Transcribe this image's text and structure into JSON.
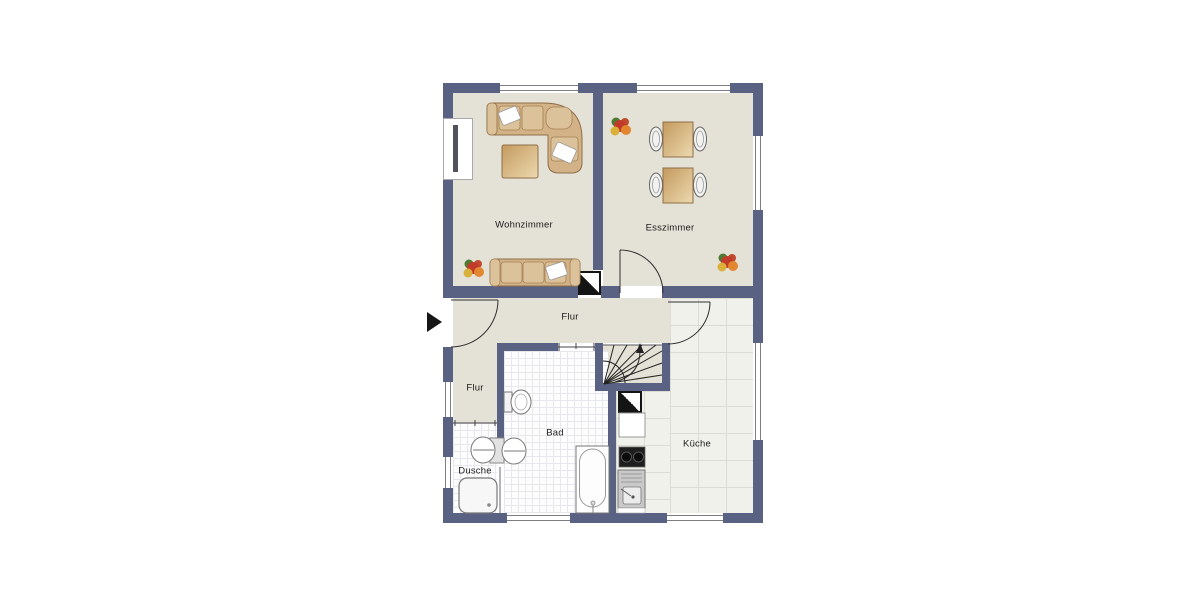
{
  "plan": {
    "title": "Grundriss",
    "rooms": [
      {
        "id": "wohnzimmer",
        "label": "Wohnzimmer"
      },
      {
        "id": "esszimmer",
        "label": "Esszimmer"
      },
      {
        "id": "flur",
        "label": "Flur"
      },
      {
        "id": "flur-klein",
        "label": "Flur"
      },
      {
        "id": "bad",
        "label": "Bad"
      },
      {
        "id": "dusche",
        "label": "Dusche"
      },
      {
        "id": "kueche",
        "label": "Küche"
      }
    ],
    "colors": {
      "wall": "#5a6284",
      "floor_living": "#e4e1d6",
      "floor_bath": "#fdfdfd",
      "floor_kitchen": "#f1f1ec",
      "furniture": "#d2b286",
      "furniture_border": "#8f6e48"
    },
    "icons": [
      {
        "name": "entrance-arrow-icon",
        "meaning": "entrance direction marker"
      },
      {
        "name": "chimney-icon",
        "meaning": "chimney / shaft symbol"
      },
      {
        "name": "stairs-up-arrow-icon",
        "meaning": "stair direction up"
      }
    ]
  }
}
